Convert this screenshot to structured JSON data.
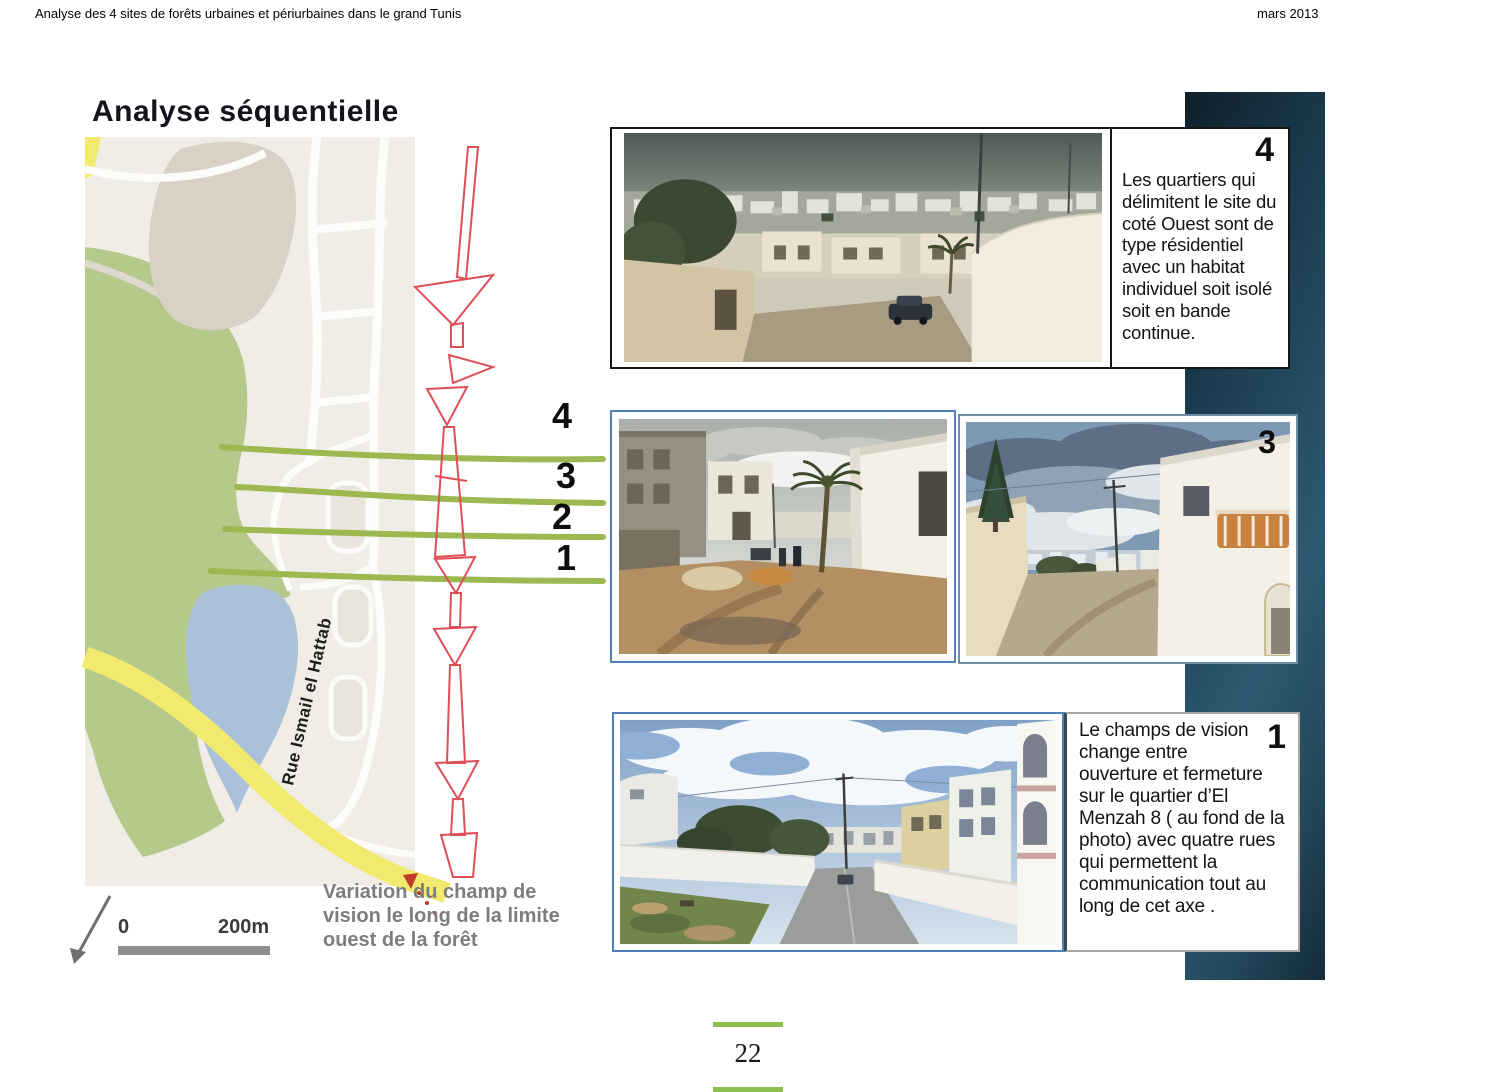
{
  "header": {
    "left": "Analyse des 4 sites de forêts urbaines et périurbaines dans le grand Tunis",
    "right": "mars 2013"
  },
  "title": "Analyse séquentielle",
  "map": {
    "street_label": "Rue Ismail el Hattab",
    "sequence_labels": [
      "4",
      "3",
      "2",
      "1"
    ],
    "scale": {
      "zero": "0",
      "label": "200m"
    },
    "caption": "Variation du champ  de vision le long de la limite ouest de la forêt",
    "colors": {
      "base_beige": "#f0ede6",
      "forest_green": "#b5c98b",
      "lake_blue": "#a9c2da",
      "road_yellow": "#f2ea6e",
      "section_line_green": "#9cb850",
      "sightline_red": "#de4f58",
      "built_block": "#d9d1c5"
    }
  },
  "annotations": {
    "block4": {
      "number": "4",
      "text": "Les quartiers qui délimitent le site du coté Ouest sont de type résidentiel avec un habitat individuel soit isolé soit en bande continue."
    },
    "block3": {
      "number": "3"
    },
    "block1": {
      "number": "1",
      "text": "Le champs de vision change entre ouverture et fermeture sur le quartier d’El Menzah 8 ( au fond de la photo) avec quatre rues qui permettent la communication tout au long de cet axe ."
    }
  },
  "footer": {
    "page_number": "22",
    "accent_green": "#8cbf4d"
  },
  "colors": {
    "band_dark": "#152c3a",
    "band_mid": "#2d5a72",
    "photo_border_blue": "#4f81bd"
  }
}
